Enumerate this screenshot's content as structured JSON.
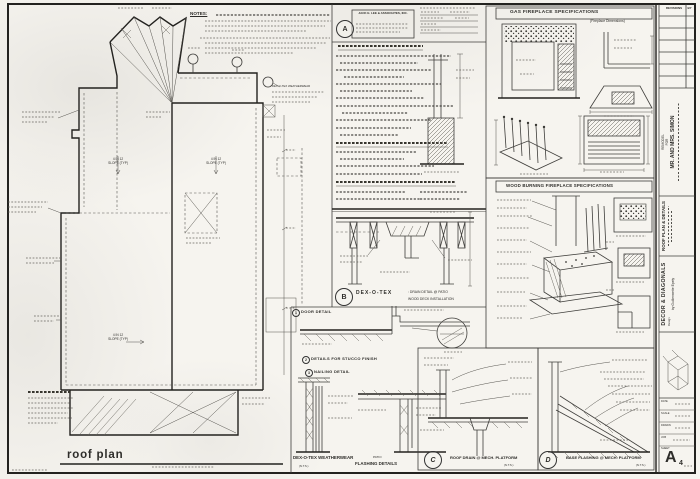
{
  "colors": {
    "paper": "#f6f4ef",
    "ink": "#3f3e3b"
  },
  "sheet": {
    "notes_label": "NOTES:",
    "plan_title": "roof plan"
  },
  "plan_labels": {
    "slope_line1": "4 IN 12",
    "slope_line2": "SLOPE (TYP)",
    "weatherwear_note": "DEX-O-TEX WEATHERWEAR"
  },
  "stamp": {
    "marker": "A",
    "firm": "JACK E. LEE & ASSOCIATES, INC."
  },
  "details": {
    "b_marker": "B",
    "b_title": "DEX-O-TEX",
    "b_sub1": ": DRAIN DETAIL @ PATIO",
    "b_sub2": "WOOD DECK INSTALLATION",
    "door_num": "1",
    "door_label": "DOOR DETAIL",
    "stucco_num": "2",
    "stucco_label": "DETAILS FOR STUCCO FINISH",
    "nailing_num": "3",
    "nailing_label": "NAILING DETAIL",
    "weatherwear_title": "DEX-O-TEX WEATHERWEAR",
    "weatherwear_nts": "(N.T.S.)",
    "patio_label": "PATIO",
    "flashing_label": "FLASHING DETAILS",
    "c_marker": "C",
    "c_title": "ROOF DRAIN @ MECH. PLATFORM",
    "c_nts": "(N.T.S.)",
    "d_marker": "D",
    "d_title": "BASE FLASHING @ MECH. PLATFORM",
    "d_nts": "(N.T.S.)"
  },
  "fireplace": {
    "gas_title": "GAS FIREPLACE SPECIFICATIONS",
    "gas_dim_label": "(Fireplace Dimensions)",
    "wood_title": "WOOD BURNING FIREPLACE SPECIFICATIONS"
  },
  "titleblock": {
    "revisions_label": "REVISIONS",
    "by_label": "BY",
    "project_line1": "REMODEL",
    "project_line2": "FOR",
    "project_line3": "MR. AND MRS. SIMON",
    "sheet_title": "ROOF PLAN & DETAILS",
    "firm_name": "DECOR & DIAGONALS",
    "firm_line2": "Design",
    "firm_line3": "by Guillermette Epely",
    "sheet_label": "SHEET",
    "sheet_letter": "A",
    "sheet_number": "4",
    "field_date": "DATE",
    "field_scale": "SCALE",
    "field_drawn": "DRAWN",
    "field_job": "JOB"
  }
}
